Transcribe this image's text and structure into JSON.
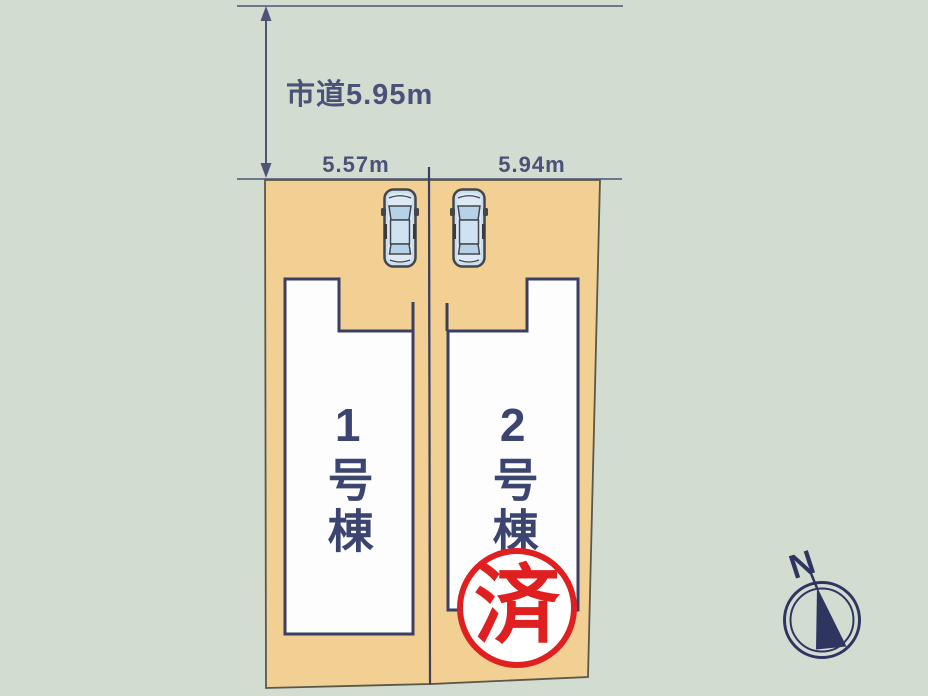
{
  "scene": {
    "road_label": "市道5.95m",
    "lot1": {
      "width_label": "5.57m",
      "name": "1号棟",
      "sold": false
    },
    "lot2": {
      "width_label": "5.94m",
      "name": "2号棟",
      "sold": true,
      "stamp": "済"
    },
    "compass": {
      "north_label": "N"
    }
  },
  "icons": {
    "car1": "car-top-view-icon",
    "car2": "car-top-view-icon",
    "compass": "north-compass-icon",
    "dimension_arrow": "double-arrow-icon",
    "sold_stamp": "sold-stamp-icon"
  },
  "colors": {
    "background": "#d3dcd1",
    "lot_fill": "#f2cf93",
    "outline_navy": "#3b3f63",
    "line_navy": "#4d5576",
    "text_navy": "#4a5377",
    "stamp_red": "#e02020",
    "house_fill": "#fdfdfd",
    "car_body": "#c9dff0"
  }
}
